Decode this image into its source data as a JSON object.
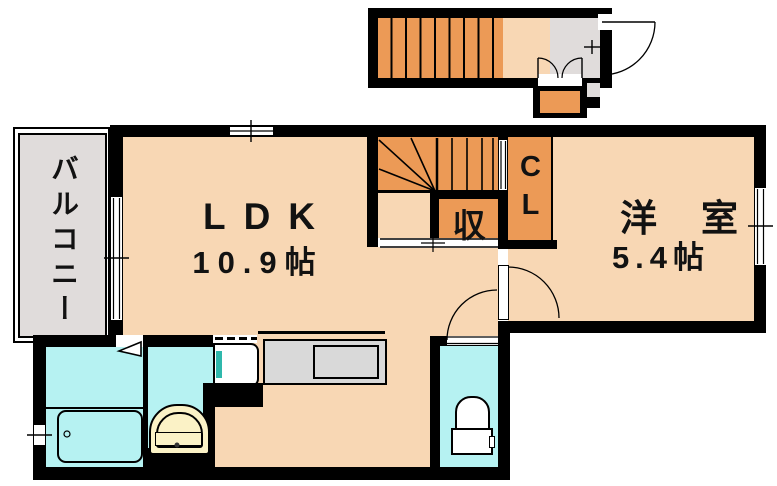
{
  "plan": {
    "balcony": {
      "label": "バルコニー"
    },
    "ldk": {
      "label": "LDK",
      "area": "10.9帖"
    },
    "western_room": {
      "label": "洋室",
      "area": "5.4帖"
    },
    "storage": {
      "label": "収"
    },
    "closet": {
      "label": "CL"
    }
  },
  "fixtures": {
    "bathtub": "bathtub",
    "washbasin": "washbasin",
    "washing_machine": "washing-machine-space",
    "kitchen_counter": "kitchen-counter-with-sink",
    "toilet": "toilet",
    "interior_stairs": "interior-winder-staircase",
    "exterior_stairs": "exterior-staircase",
    "entrance_door": "entrance-door-swing",
    "doors": "interior-door-swings",
    "windows": "window-openings"
  },
  "colors": {
    "wall": "#000000",
    "floor": "#f8d7b4",
    "orange": "#ec9a56",
    "cyan": "#b6f2f2",
    "gray": "#e0dcdb",
    "counter": "#d9d9d9",
    "cream": "#fbf2c6",
    "teal": "#2fb8ac",
    "paper": "#ffffff"
  }
}
